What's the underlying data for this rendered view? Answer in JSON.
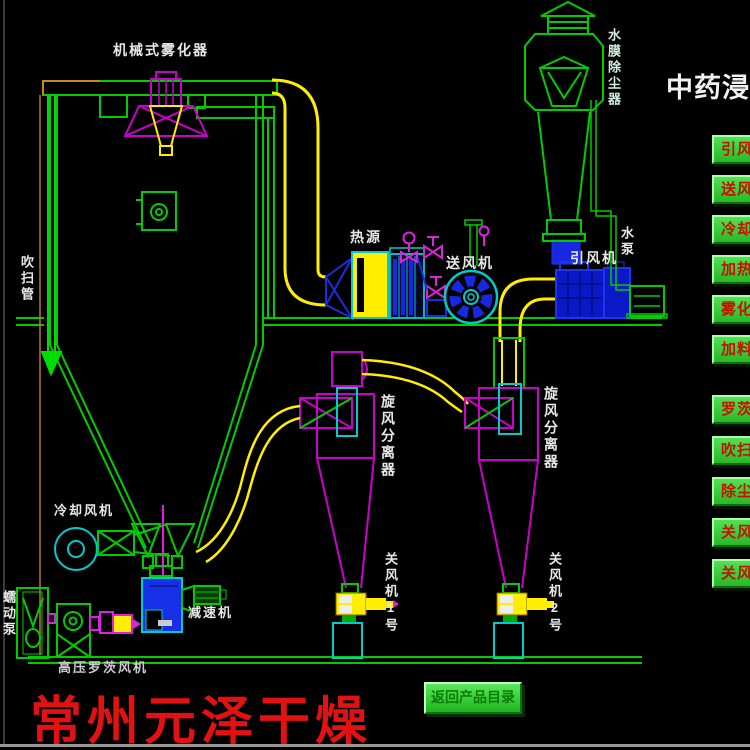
{
  "title": "中药浸膏",
  "colors": {
    "background": "#000000",
    "line_green": "#00cc00",
    "line_magenta": "#cc00cc",
    "line_yellow": "#ffee00",
    "line_cyan": "#00cccc",
    "line_blue": "#1c2ce0",
    "button_face_green": "#3ccc3c",
    "button_text_red": "#c21200",
    "watermark_red": "#e31212"
  },
  "equipment_labels": {
    "atomizer": "机械式雾化器",
    "dust_collector": "水膜除尘器",
    "purge_pipe": "吹扫管",
    "heat_source": "热源",
    "supply_fan": "送风机",
    "induced_draft_fan": "引风机",
    "water_pump": "水泵",
    "cyclone_1": "旋风分离器",
    "cyclone_2": "旋风分离器",
    "cooling_fan": "冷却风机",
    "reducer": "减速机",
    "roots_blower": "高压罗茨风机",
    "peristaltic_pump": "蠕动泵",
    "airlock_1": "关风机1号",
    "airlock_2": "关风机2号"
  },
  "side_buttons": [
    "引风",
    "送风",
    "冷却",
    "加热",
    "雾化",
    "加料",
    "罗茨",
    "吹扫",
    "除尘",
    "关风",
    "关风"
  ],
  "footer": {
    "watermark": "常州元泽干燥",
    "back_button": "返回产品目录"
  }
}
